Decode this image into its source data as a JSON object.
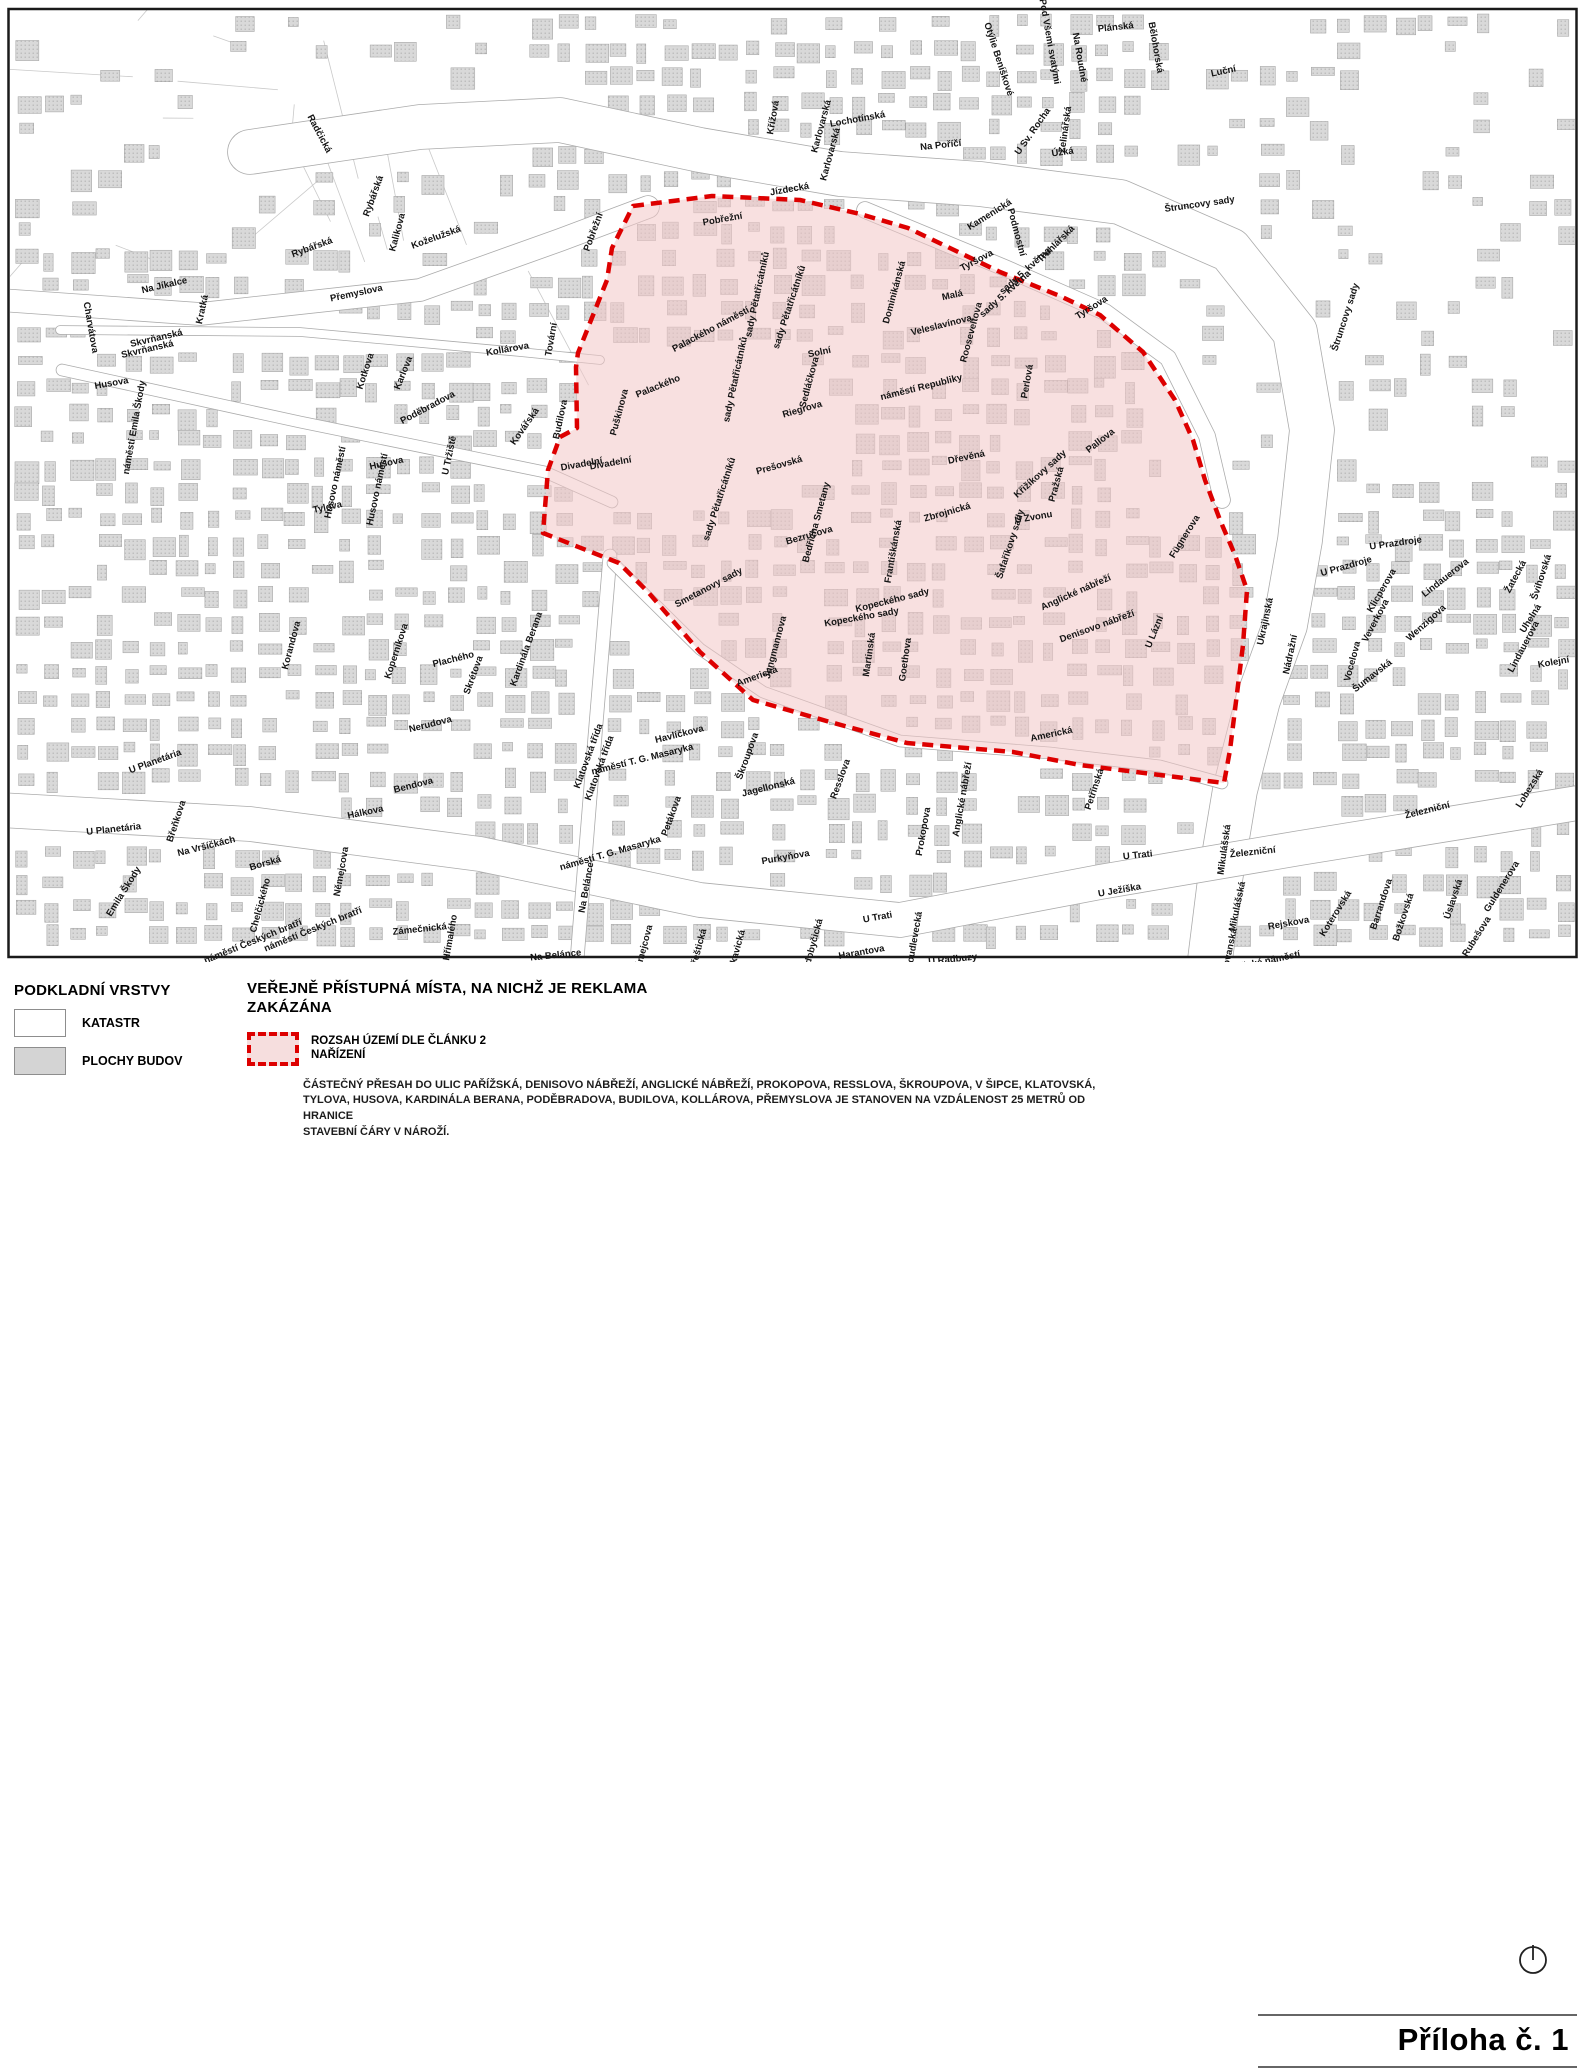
{
  "legend": {
    "section_title": "PODKLADNÍ VRSTVY",
    "items": [
      {
        "label": "KATASTR"
      },
      {
        "label": "PLOCHY BUDOV"
      }
    ],
    "title_line1": "VEŘEJNĚ PŘÍSTUPNÁ MÍSTA, NA NICHŽ JE REKLAMA",
    "title_line2": "ZAKÁZÁNA",
    "zone_item_line1": "ROZSAH ÚZEMÍ DLE ČLÁNKU 2",
    "zone_item_line2": "NAŘÍZENÍ",
    "note_line1": "ČÁSTEČNÝ PŘESAH DO ULIC PAŘÍŽSKÁ, DENISOVO NÁBŘEŽÍ, ANGLICKÉ NÁBŘEŽÍ, PROKOPOVA, RESSLOVA, ŠKROUPOVA, V ŠIPCE, KLATOVSKÁ,",
    "note_line2": "TYLOVA, HUSOVA, KARDINÁLA BERANA, PODĚBRADOVA, BUDILOVA, KOLLÁROVA, PŘEMYSLOVA JE STANOVEN NA VZDÁLENOST 25 METRŮ OD HRANICE",
    "note_line3": "STAVEBNÍ ČÁRY V NÁROŽÍ."
  },
  "annex_label": "Příloha č. 1",
  "colors": {
    "zone_fill": "rgba(242,198,198,0.55)",
    "zone_border": "#dd0000",
    "building_fill": "#d9d9d9",
    "building_dot": "#b3b3b3",
    "building_stroke": "#9e9e9e",
    "road_edge": "#ababab"
  },
  "map": {
    "street_labels": [
      {
        "t": "Radčická",
        "x": 317,
        "y": 135,
        "r": 62
      },
      {
        "t": "Rybářská",
        "x": 376,
        "y": 197,
        "r": -70
      },
      {
        "t": "Rybářská",
        "x": 313,
        "y": 250,
        "r": -20
      },
      {
        "t": "Kalikova",
        "x": 400,
        "y": 233,
        "r": -75
      },
      {
        "t": "Koželužská",
        "x": 437,
        "y": 240,
        "r": -20
      },
      {
        "t": "Na Jíkalce",
        "x": 165,
        "y": 288,
        "r": -13
      },
      {
        "t": "Kratká",
        "x": 205,
        "y": 310,
        "r": -78
      },
      {
        "t": "Charvátova",
        "x": 88,
        "y": 328,
        "r": 80
      },
      {
        "t": "Skvrňanská",
        "x": 157,
        "y": 341,
        "r": -13
      },
      {
        "t": "Skvrňanská",
        "x": 148,
        "y": 352,
        "r": -13
      },
      {
        "t": "Přemyslova",
        "x": 357,
        "y": 296,
        "r": -12
      },
      {
        "t": "Husova",
        "x": 112,
        "y": 386,
        "r": -10
      },
      {
        "t": "náměstí Emila Škody",
        "x": 137,
        "y": 428,
        "r": -80
      },
      {
        "t": "Kotkova",
        "x": 368,
        "y": 372,
        "r": -72
      },
      {
        "t": "Karlova",
        "x": 406,
        "y": 374,
        "r": -68
      },
      {
        "t": "Poděbradova",
        "x": 429,
        "y": 410,
        "r": -28
      },
      {
        "t": "Kollárova",
        "x": 508,
        "y": 352,
        "r": -10
      },
      {
        "t": "U Tržiště",
        "x": 452,
        "y": 456,
        "r": -78
      },
      {
        "t": "Kovářská",
        "x": 527,
        "y": 428,
        "r": -55
      },
      {
        "t": "Budilova",
        "x": 563,
        "y": 420,
        "r": -78
      },
      {
        "t": "Tovární",
        "x": 554,
        "y": 340,
        "r": -80
      },
      {
        "t": "Husovo náměstí",
        "x": 338,
        "y": 483,
        "r": -78
      },
      {
        "t": "Husovo náměstí",
        "x": 380,
        "y": 490,
        "r": -78
      },
      {
        "t": "Husova",
        "x": 387,
        "y": 466,
        "r": -12
      },
      {
        "t": "Tylova",
        "x": 328,
        "y": 510,
        "r": -12
      },
      {
        "t": "Korandova",
        "x": 294,
        "y": 646,
        "r": -75
      },
      {
        "t": "Koperníkova",
        "x": 399,
        "y": 652,
        "r": -72
      },
      {
        "t": "Plachého",
        "x": 454,
        "y": 662,
        "r": -14
      },
      {
        "t": "Skrétova",
        "x": 476,
        "y": 676,
        "r": -70
      },
      {
        "t": "Kardinála Berana",
        "x": 529,
        "y": 650,
        "r": -70
      },
      {
        "t": "Nerudova",
        "x": 431,
        "y": 727,
        "r": -14
      },
      {
        "t": "Bendova",
        "x": 414,
        "y": 788,
        "r": -14
      },
      {
        "t": "Hálkova",
        "x": 366,
        "y": 815,
        "r": -12
      },
      {
        "t": "Klatovská třída",
        "x": 591,
        "y": 757,
        "r": -70
      },
      {
        "t": "Klatovská třída",
        "x": 602,
        "y": 769,
        "r": -70
      },
      {
        "t": "U Planetária",
        "x": 156,
        "y": 764,
        "r": -20
      },
      {
        "t": "U Planetária",
        "x": 114,
        "y": 832,
        "r": -6
      },
      {
        "t": "Břeňkova",
        "x": 179,
        "y": 822,
        "r": -72
      },
      {
        "t": "Na Vršíčkách",
        "x": 207,
        "y": 849,
        "r": -14
      },
      {
        "t": "Borská",
        "x": 266,
        "y": 866,
        "r": -16
      },
      {
        "t": "Emila Škody",
        "x": 126,
        "y": 893,
        "r": -58
      },
      {
        "t": "Chelčického",
        "x": 263,
        "y": 906,
        "r": -75
      },
      {
        "t": "náměstí Českých bratří",
        "x": 254,
        "y": 944,
        "r": -22
      },
      {
        "t": "náměstí Českých bratří",
        "x": 314,
        "y": 932,
        "r": -22
      },
      {
        "t": "Němejcova",
        "x": 344,
        "y": 872,
        "r": -80
      },
      {
        "t": "Zámečnická",
        "x": 420,
        "y": 932,
        "r": -6
      },
      {
        "t": "Hřímalého",
        "x": 453,
        "y": 938,
        "r": -80
      },
      {
        "t": "Na Belánce",
        "x": 589,
        "y": 888,
        "r": -80
      },
      {
        "t": "Na Belánce",
        "x": 556,
        "y": 958,
        "r": -6
      },
      {
        "t": "Němejcova",
        "x": 646,
        "y": 950,
        "r": -75
      },
      {
        "t": "Přeštická",
        "x": 701,
        "y": 950,
        "r": -75
      },
      {
        "t": "Lukavická",
        "x": 739,
        "y": 953,
        "r": -75
      },
      {
        "t": "Radobyčická",
        "x": 815,
        "y": 948,
        "r": -75
      },
      {
        "t": "Harantova",
        "x": 862,
        "y": 955,
        "r": -10
      },
      {
        "t": "Doudlevecká",
        "x": 917,
        "y": 941,
        "r": -80
      },
      {
        "t": "U Radbuzy",
        "x": 953,
        "y": 962,
        "r": -6
      },
      {
        "t": "U Trati",
        "x": 878,
        "y": 920,
        "r": -10
      },
      {
        "t": "U Trati",
        "x": 1138,
        "y": 858,
        "r": -6
      },
      {
        "t": "U Ježíška",
        "x": 1120,
        "y": 893,
        "r": -10
      },
      {
        "t": "Havlíčkova",
        "x": 680,
        "y": 737,
        "r": -14
      },
      {
        "t": "náměstí T. G. Masaryka",
        "x": 643,
        "y": 762,
        "r": -14
      },
      {
        "t": "náměstí T. G. Masaryka",
        "x": 611,
        "y": 856,
        "r": -16
      },
      {
        "t": "Petákova",
        "x": 674,
        "y": 817,
        "r": -70
      },
      {
        "t": "Škroupova",
        "x": 750,
        "y": 757,
        "r": -70
      },
      {
        "t": "Jagellonská",
        "x": 769,
        "y": 790,
        "r": -14
      },
      {
        "t": "Resslova",
        "x": 843,
        "y": 780,
        "r": -70
      },
      {
        "t": "Purkyňova",
        "x": 786,
        "y": 860,
        "r": -10
      },
      {
        "t": "Prokopova",
        "x": 926,
        "y": 832,
        "r": -80
      },
      {
        "t": "Anglické nábřeží",
        "x": 965,
        "y": 800,
        "r": -80
      },
      {
        "t": "Pobřežní",
        "x": 596,
        "y": 233,
        "r": -70
      },
      {
        "t": "Jízdecká",
        "x": 790,
        "y": 192,
        "r": -10
      },
      {
        "t": "Křížová",
        "x": 776,
        "y": 118,
        "r": -80
      },
      {
        "t": "Karlovarská",
        "x": 824,
        "y": 127,
        "r": -75
      },
      {
        "t": "Karlovarská",
        "x": 833,
        "y": 155,
        "r": -75
      },
      {
        "t": "Lochotínská",
        "x": 858,
        "y": 122,
        "r": -10
      },
      {
        "t": "Na Poříčí",
        "x": 941,
        "y": 148,
        "r": -6
      },
      {
        "t": "Otýlie Beníškové",
        "x": 996,
        "y": 60,
        "r": 72
      },
      {
        "t": "Pod Všemi svatými",
        "x": 1047,
        "y": 42,
        "r": 80
      },
      {
        "t": "Na Roudné",
        "x": 1077,
        "y": 58,
        "r": 80
      },
      {
        "t": "Plánská",
        "x": 1116,
        "y": 30,
        "r": -6
      },
      {
        "t": "Bělohorská",
        "x": 1153,
        "y": 48,
        "r": 80
      },
      {
        "t": "Luční",
        "x": 1224,
        "y": 74,
        "r": -12
      },
      {
        "t": "U Sv. Rocha",
        "x": 1035,
        "y": 133,
        "r": -55
      },
      {
        "t": "Zelinářská",
        "x": 1068,
        "y": 130,
        "r": -82
      },
      {
        "t": "Úzká",
        "x": 1063,
        "y": 155,
        "r": -8
      },
      {
        "t": "Kamenická",
        "x": 991,
        "y": 217,
        "r": -32
      },
      {
        "t": "Podmostní",
        "x": 1014,
        "y": 233,
        "r": 75
      },
      {
        "t": "Truhlářská",
        "x": 1058,
        "y": 246,
        "r": -45
      },
      {
        "t": "Štruncovy sady",
        "x": 1200,
        "y": 207,
        "r": -8
      },
      {
        "t": "Štruncovy sady",
        "x": 1348,
        "y": 318,
        "r": -72
      },
      {
        "t": "Pobřežní",
        "x": 723,
        "y": 222,
        "r": -10
      },
      {
        "t": "Palackého náměstí",
        "x": 712,
        "y": 332,
        "r": -28
      },
      {
        "t": "sady Pětatřicátníků",
        "x": 760,
        "y": 295,
        "r": -78
      },
      {
        "t": "sady Pětatřicátníků",
        "x": 792,
        "y": 308,
        "r": -72
      },
      {
        "t": "sady Pětatřicátníků",
        "x": 738,
        "y": 380,
        "r": -78
      },
      {
        "t": "sady Pětatřicátníků",
        "x": 722,
        "y": 500,
        "r": -72
      },
      {
        "t": "Palackého",
        "x": 659,
        "y": 389,
        "r": -22
      },
      {
        "t": "Puškinova",
        "x": 622,
        "y": 413,
        "r": -75
      },
      {
        "t": "Divadelní",
        "x": 582,
        "y": 467,
        "r": -10
      },
      {
        "t": "Divadelní",
        "x": 611,
        "y": 466,
        "r": -10
      },
      {
        "t": "Solní",
        "x": 820,
        "y": 355,
        "r": -12
      },
      {
        "t": "Sedláčkova",
        "x": 812,
        "y": 383,
        "r": -75
      },
      {
        "t": "Riegrova",
        "x": 803,
        "y": 412,
        "r": -16
      },
      {
        "t": "Dominikánská",
        "x": 897,
        "y": 293,
        "r": -75
      },
      {
        "t": "Malá",
        "x": 953,
        "y": 298,
        "r": -12
      },
      {
        "t": "Veleslavínova",
        "x": 942,
        "y": 328,
        "r": -14
      },
      {
        "t": "Rooseveltova",
        "x": 974,
        "y": 333,
        "r": -75
      },
      {
        "t": "sady 5. května",
        "x": 1027,
        "y": 273,
        "r": -42
      },
      {
        "t": "sady 5. května",
        "x": 1007,
        "y": 296,
        "r": -42
      },
      {
        "t": "Tyršova",
        "x": 978,
        "y": 263,
        "r": -28
      },
      {
        "t": "Tyršova",
        "x": 1093,
        "y": 310,
        "r": -32
      },
      {
        "t": "náměstí Republiky",
        "x": 922,
        "y": 390,
        "r": -14
      },
      {
        "t": "Perlová",
        "x": 1030,
        "y": 382,
        "r": -80
      },
      {
        "t": "Dřevěná",
        "x": 967,
        "y": 460,
        "r": -12
      },
      {
        "t": "Křižíkovy sady",
        "x": 1042,
        "y": 476,
        "r": -42
      },
      {
        "t": "Pražská",
        "x": 1059,
        "y": 485,
        "r": -75
      },
      {
        "t": "Pallova",
        "x": 1102,
        "y": 443,
        "r": -38
      },
      {
        "t": "Prešovská",
        "x": 780,
        "y": 468,
        "r": -16
      },
      {
        "t": "Bedřicha Smetany",
        "x": 819,
        "y": 523,
        "r": -75
      },
      {
        "t": "Bezručova",
        "x": 810,
        "y": 538,
        "r": -16
      },
      {
        "t": "Zbrojnická",
        "x": 948,
        "y": 515,
        "r": -16
      },
      {
        "t": "Františkánská",
        "x": 896,
        "y": 552,
        "r": -80
      },
      {
        "t": "U Zvonu",
        "x": 1034,
        "y": 520,
        "r": -10
      },
      {
        "t": "Šafaříkovy sady",
        "x": 1013,
        "y": 545,
        "r": -72
      },
      {
        "t": "Smetanovy sady",
        "x": 710,
        "y": 590,
        "r": -28
      },
      {
        "t": "Kopeckého sady",
        "x": 893,
        "y": 603,
        "r": -14
      },
      {
        "t": "Kopeckého sady",
        "x": 862,
        "y": 620,
        "r": -10
      },
      {
        "t": "Jungmannova",
        "x": 778,
        "y": 648,
        "r": -75
      },
      {
        "t": "Americká",
        "x": 758,
        "y": 679,
        "r": -20
      },
      {
        "t": "Martinská",
        "x": 872,
        "y": 655,
        "r": -82
      },
      {
        "t": "Goethova",
        "x": 908,
        "y": 660,
        "r": -82
      },
      {
        "t": "Anglické nábřeží",
        "x": 1077,
        "y": 595,
        "r": -24
      },
      {
        "t": "Denisovo nábřeží",
        "x": 1098,
        "y": 629,
        "r": -20
      },
      {
        "t": "U Lázní",
        "x": 1157,
        "y": 633,
        "r": -68
      },
      {
        "t": "Fügnerova",
        "x": 1187,
        "y": 538,
        "r": -58
      },
      {
        "t": "Americká",
        "x": 1052,
        "y": 737,
        "r": -12
      },
      {
        "t": "Petřínská",
        "x": 1097,
        "y": 790,
        "r": -72
      },
      {
        "t": "Ukrajinská",
        "x": 1268,
        "y": 622,
        "r": -78
      },
      {
        "t": "Nádražní",
        "x": 1293,
        "y": 655,
        "r": -78
      },
      {
        "t": "U Prazdroje",
        "x": 1396,
        "y": 546,
        "r": -8
      },
      {
        "t": "U Prazdroje",
        "x": 1347,
        "y": 569,
        "r": -16
      },
      {
        "t": "Klicperova",
        "x": 1384,
        "y": 592,
        "r": -60
      },
      {
        "t": "Lindauerova",
        "x": 1447,
        "y": 580,
        "r": -38
      },
      {
        "t": "Veverkova",
        "x": 1378,
        "y": 622,
        "r": -62
      },
      {
        "t": "Wenzigova",
        "x": 1428,
        "y": 625,
        "r": -42
      },
      {
        "t": "Vocelova",
        "x": 1355,
        "y": 662,
        "r": -75
      },
      {
        "t": "Šumavská",
        "x": 1374,
        "y": 678,
        "r": -38
      },
      {
        "t": "Žatecká",
        "x": 1518,
        "y": 578,
        "r": -62
      },
      {
        "t": "Švihovská",
        "x": 1544,
        "y": 578,
        "r": -72
      },
      {
        "t": "Uhelná",
        "x": 1533,
        "y": 620,
        "r": -58
      },
      {
        "t": "Lindauerova",
        "x": 1526,
        "y": 648,
        "r": -62
      },
      {
        "t": "Kolejní",
        "x": 1554,
        "y": 665,
        "r": -10
      },
      {
        "t": "Železniční",
        "x": 1428,
        "y": 813,
        "r": -14
      },
      {
        "t": "Železniční",
        "x": 1253,
        "y": 855,
        "r": -6
      },
      {
        "t": "Mikulášská",
        "x": 1227,
        "y": 850,
        "r": -82
      },
      {
        "t": "Mikulášská",
        "x": 1240,
        "y": 907,
        "r": -78
      },
      {
        "t": "Slovanská",
        "x": 1232,
        "y": 952,
        "r": -78
      },
      {
        "t": "Rejskova",
        "x": 1289,
        "y": 926,
        "r": -10
      },
      {
        "t": "Mikulášské náměstí",
        "x": 1257,
        "y": 966,
        "r": -12
      },
      {
        "t": "Koterovská",
        "x": 1338,
        "y": 915,
        "r": -58
      },
      {
        "t": "Barrandova",
        "x": 1384,
        "y": 905,
        "r": -72
      },
      {
        "t": "Božkovská",
        "x": 1406,
        "y": 918,
        "r": -72
      },
      {
        "t": "Úslavská",
        "x": 1456,
        "y": 900,
        "r": -72
      },
      {
        "t": "Rubešova",
        "x": 1479,
        "y": 938,
        "r": -58
      },
      {
        "t": "Guldenerova",
        "x": 1504,
        "y": 888,
        "r": -58
      },
      {
        "t": "Lobezská",
        "x": 1532,
        "y": 790,
        "r": -58
      }
    ]
  }
}
